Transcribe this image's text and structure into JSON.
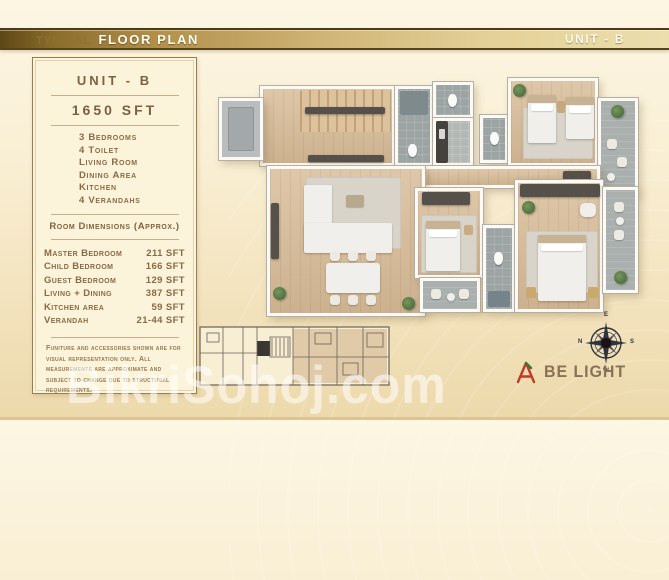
{
  "page": {
    "watermark": "BikriSohoj.com"
  },
  "top_bar": {
    "label_prefix": "TYPICAL",
    "label_main": "FLOOR PLAN",
    "unit": "UNIT - B"
  },
  "info_panel": {
    "unit_title": "UNIT - B",
    "area": "1650 SFT",
    "features": [
      "3 Bedrooms",
      "4 Toilet",
      "Living Room",
      "Dining Area",
      "Kitchen",
      "4 Verandahs"
    ],
    "dimensions_title": "Room Dimensions (Approx.)",
    "dimensions": [
      {
        "room": "Master Bedroom",
        "area": "211 SFT"
      },
      {
        "room": "Child Bedroom",
        "area": "166 SFT"
      },
      {
        "room": "Guest Bedroom",
        "area": "129 SFT"
      },
      {
        "room": "Living + Dining",
        "area": "387 SFT"
      },
      {
        "room": "Kitchen area",
        "area": "59 SFT"
      },
      {
        "room": "Verandah",
        "area": "21-44 SFT"
      }
    ],
    "disclaimer": "Funiture and accessories shown are for visual representation only. All measurements are approximate and subject to change due to structural requirements."
  },
  "compass": {
    "top": "E",
    "right": "S",
    "bottom": "W",
    "left": "N"
  },
  "brand": {
    "name": "BE LIGHT"
  },
  "colors": {
    "gold_dark": "#5e4716",
    "gold_light": "#ecdfae",
    "panel_bg": "#fcf4da",
    "panel_text": "#8a6a45",
    "wood_floor": "#d7bb96",
    "tile_gray": "#9da4a4",
    "logo_red": "#c0392b",
    "logo_green": "#2e7d32",
    "brand_text": "#8a7158"
  }
}
